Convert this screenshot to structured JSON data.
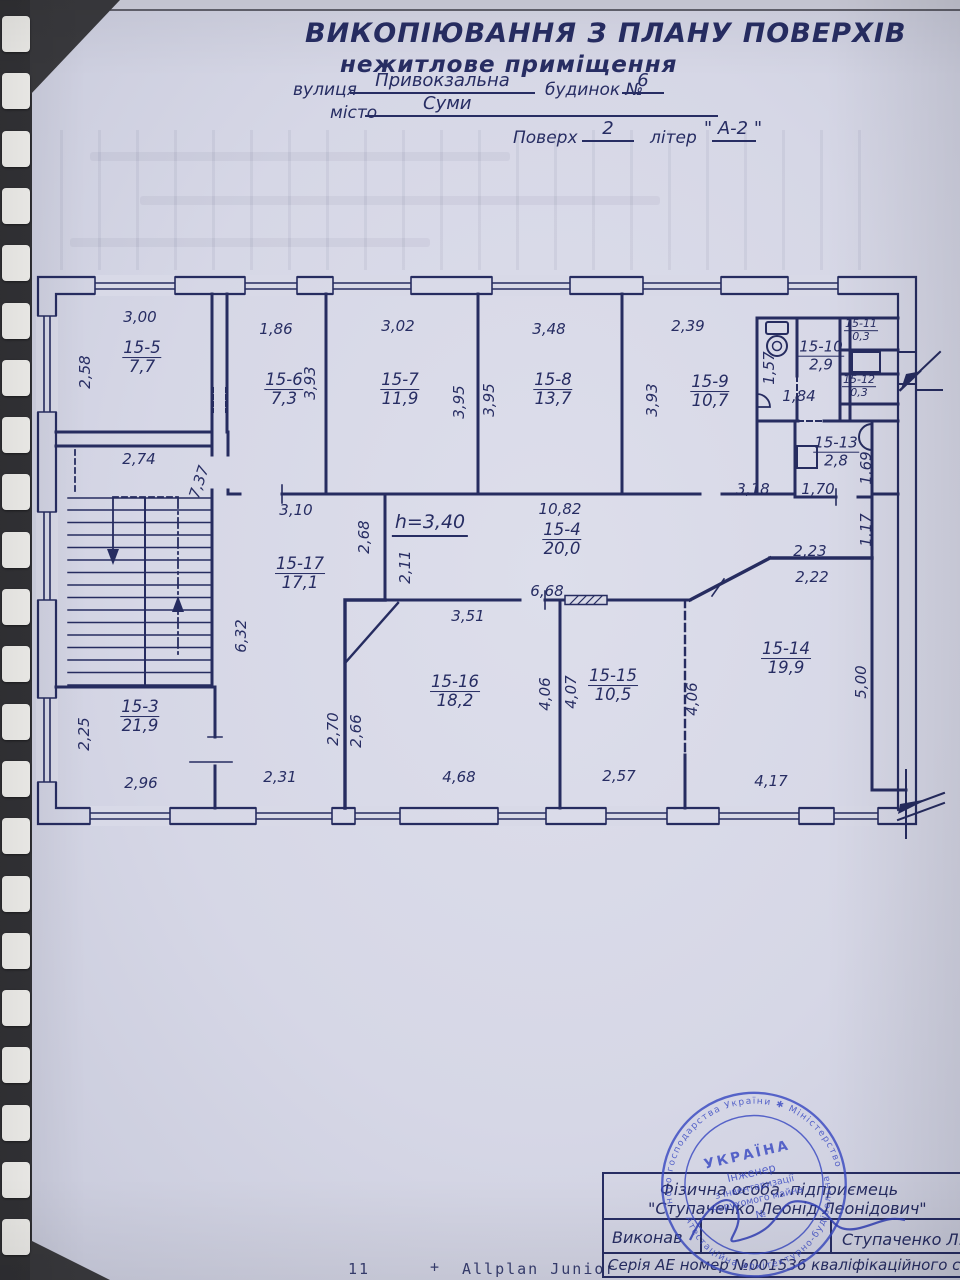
{
  "document": {
    "title": "ВИКОПІЮВАННЯ З ПЛАНУ ПОВЕРХІВ",
    "subtitle": "нежитлове приміщення",
    "street_label": "вулиця",
    "street_value": "Привокзальна",
    "building_label": "будинок №",
    "building_value": "6",
    "city_label": "місто",
    "city_value": "Суми",
    "floor_label": "Поверх",
    "floor_value": "2",
    "letter_label": "літер",
    "letter_value": "\" А-2 \""
  },
  "plan": {
    "ink_color": "#272d63",
    "height_note": "h=3,40",
    "rooms": [
      {
        "id": "15-5",
        "area": "7,7",
        "x": 142,
        "y": 358
      },
      {
        "id": "15-6",
        "area": "7,3",
        "x": 284,
        "y": 390
      },
      {
        "id": "15-7",
        "area": "11,9",
        "x": 400,
        "y": 390
      },
      {
        "id": "15-8",
        "area": "13,7",
        "x": 553,
        "y": 390
      },
      {
        "id": "15-9",
        "area": "10,7",
        "x": 710,
        "y": 392
      },
      {
        "id": "15-10",
        "area": "2,9",
        "x": 821,
        "y": 356,
        "size": "mid"
      },
      {
        "id": "15-11",
        "area": "0,3",
        "x": 861,
        "y": 331,
        "size": "small"
      },
      {
        "id": "15-12",
        "area": "0,3",
        "x": 859,
        "y": 387,
        "size": "small"
      },
      {
        "id": "15-13",
        "area": "2,8",
        "x": 836,
        "y": 452,
        "size": "mid"
      },
      {
        "id": "15-4",
        "area": "20,0",
        "x": 562,
        "y": 540
      },
      {
        "id": "15-17",
        "area": "17,1",
        "x": 300,
        "y": 574
      },
      {
        "id": "15-3",
        "area": "21,9",
        "x": 140,
        "y": 717
      },
      {
        "id": "15-16",
        "area": "18,2",
        "x": 455,
        "y": 692
      },
      {
        "id": "15-15",
        "area": "10,5",
        "x": 613,
        "y": 686
      },
      {
        "id": "15-14",
        "area": "19,9",
        "x": 786,
        "y": 659
      }
    ],
    "dimensions": [
      {
        "t": "3,00",
        "x": 140,
        "y": 317
      },
      {
        "t": "2,58",
        "x": 85,
        "y": 372,
        "r": -90
      },
      {
        "t": "1,86",
        "x": 276,
        "y": 329
      },
      {
        "t": "3,93",
        "x": 310,
        "y": 383,
        "r": -90
      },
      {
        "t": "3,02",
        "x": 398,
        "y": 326
      },
      {
        "t": "3,95",
        "x": 459,
        "y": 402,
        "r": -90
      },
      {
        "t": "3,95",
        "x": 489,
        "y": 400,
        "r": -90
      },
      {
        "t": "3,48",
        "x": 549,
        "y": 329
      },
      {
        "t": "2,39",
        "x": 688,
        "y": 326
      },
      {
        "t": "3,93",
        "x": 652,
        "y": 400,
        "r": -90
      },
      {
        "t": "1,57",
        "x": 769,
        "y": 368,
        "r": -90
      },
      {
        "t": "1,84",
        "x": 799,
        "y": 396
      },
      {
        "t": "3,18",
        "x": 753,
        "y": 489
      },
      {
        "t": "1,70",
        "x": 818,
        "y": 489
      },
      {
        "t": "1,69",
        "x": 866,
        "y": 468,
        "r": -90
      },
      {
        "t": "1,17",
        "x": 866,
        "y": 530,
        "r": -90
      },
      {
        "t": "2,23",
        "x": 810,
        "y": 551
      },
      {
        "t": "2,22",
        "x": 812,
        "y": 577
      },
      {
        "t": "2,74",
        "x": 139,
        "y": 459
      },
      {
        "t": "7,37",
        "x": 199,
        "y": 482,
        "r": -72
      },
      {
        "t": "3,10",
        "x": 296,
        "y": 510
      },
      {
        "t": "10,82",
        "x": 560,
        "y": 509
      },
      {
        "t": "2,68",
        "x": 364,
        "y": 537,
        "r": -90
      },
      {
        "t": "2,11",
        "x": 405,
        "y": 567,
        "r": -90
      },
      {
        "t": "6,68",
        "x": 547,
        "y": 591
      },
      {
        "t": "3,51",
        "x": 468,
        "y": 616
      },
      {
        "t": "6,32",
        "x": 241,
        "y": 636,
        "r": -90
      },
      {
        "t": "2,25",
        "x": 84,
        "y": 734,
        "r": -90
      },
      {
        "t": "2,96",
        "x": 141,
        "y": 783
      },
      {
        "t": "2,31",
        "x": 280,
        "y": 777
      },
      {
        "t": "2,70",
        "x": 333,
        "y": 729,
        "r": -90
      },
      {
        "t": "2,66",
        "x": 356,
        "y": 731,
        "r": -90
      },
      {
        "t": "4,68",
        "x": 459,
        "y": 777
      },
      {
        "t": "4,06",
        "x": 545,
        "y": 694,
        "r": -90
      },
      {
        "t": "4,07",
        "x": 571,
        "y": 692,
        "r": -90
      },
      {
        "t": "2,57",
        "x": 619,
        "y": 776
      },
      {
        "t": "4,06",
        "x": 692,
        "y": 699,
        "r": -90
      },
      {
        "t": "5,00",
        "x": 861,
        "y": 682,
        "r": -90
      },
      {
        "t": "4,17",
        "x": 771,
        "y": 781
      }
    ]
  },
  "title_block": {
    "line1": "Фізична особа, підприємець",
    "line2": "\"Ступаченко Леонід Леонідович\"",
    "executed_label": "Виконав",
    "executed_value": "Ступаченко Л.Л.",
    "certificate_line": "Серія АЕ номер №001536 кваліфікаційного сертифікату."
  },
  "stamp": {
    "ring_top": "ного господарства України ✱ Міністерство регіо",
    "ring_bottom": "Атестаційна архітектурно-будівельна комісія",
    "center_line1": "УКРАЇНА",
    "center_line2": "Інженер",
    "center_line3": "з інвентаризації",
    "center_line4": "нерухомого майна",
    "center_line5": "№"
  },
  "footer": {
    "left_number": "11",
    "plus": "+",
    "software": "Allplan Junior"
  }
}
